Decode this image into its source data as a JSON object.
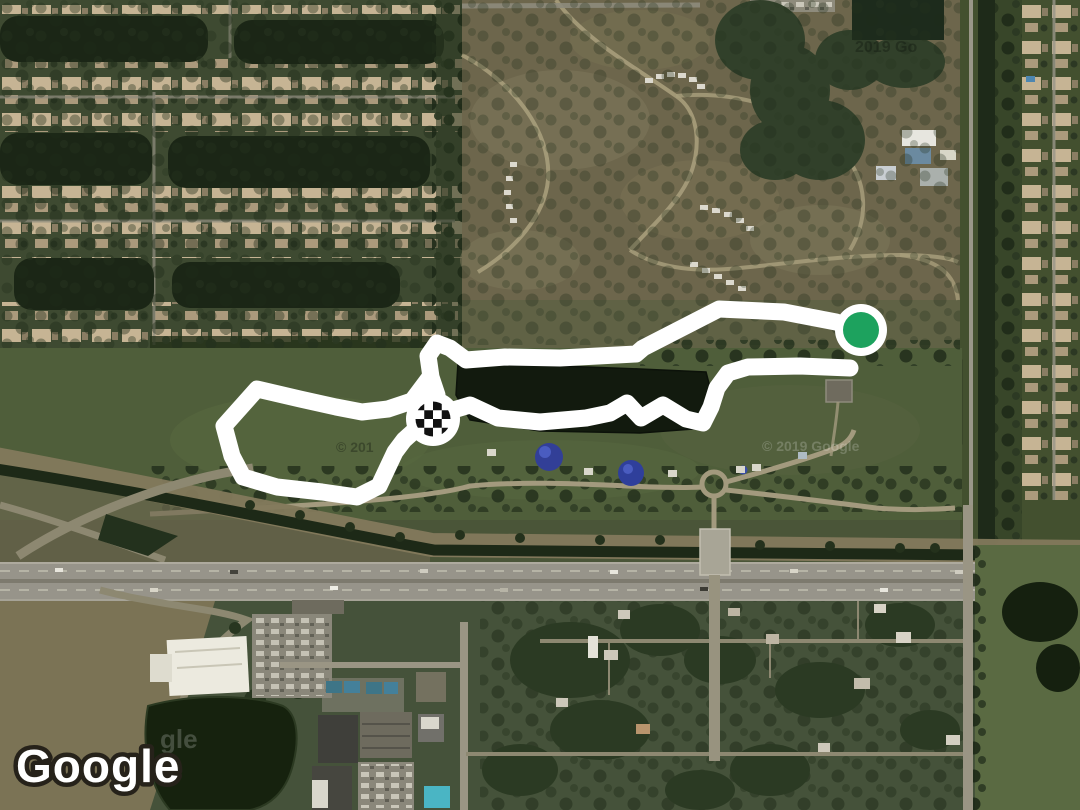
{
  "map": {
    "provider_logo": "Google",
    "watermarks": {
      "top_right": "2019 Go",
      "field_dark": "© 201",
      "lake_light": "© 2019 Google",
      "bottom_left_light": "gle"
    }
  },
  "route": {
    "color": "#ffffff",
    "stroke_width": 17,
    "segments": {
      "approach": "861,330 836,322 784,312 719,309 643,348 636,354 560,358 505,357 466,360 450,348 437,343 428,356 431,377 437,395",
      "loop": "430,377 412,401 388,409 362,412 336,407 300,399 257,389 224,426 232,456 243,477 277,487 322,492 357,497 379,486 395,452 404,440 414,431",
      "lakeside": "450,411 470,405 498,418 540,422 586,418 610,413 627,403 641,418 663,405 686,419 703,423 711,407 717,388 728,373 748,367 800,366 850,368"
    },
    "start_marker": {
      "label": "start",
      "x": 861,
      "y": 330,
      "outer_r": 26,
      "inner_r": 18,
      "ring_color": "#ffffff",
      "fill_color": "#1da25e"
    },
    "finish_marker": {
      "label": "finish",
      "x": 433,
      "y": 419,
      "outer_r": 27,
      "checker_r": 17.5
    }
  }
}
